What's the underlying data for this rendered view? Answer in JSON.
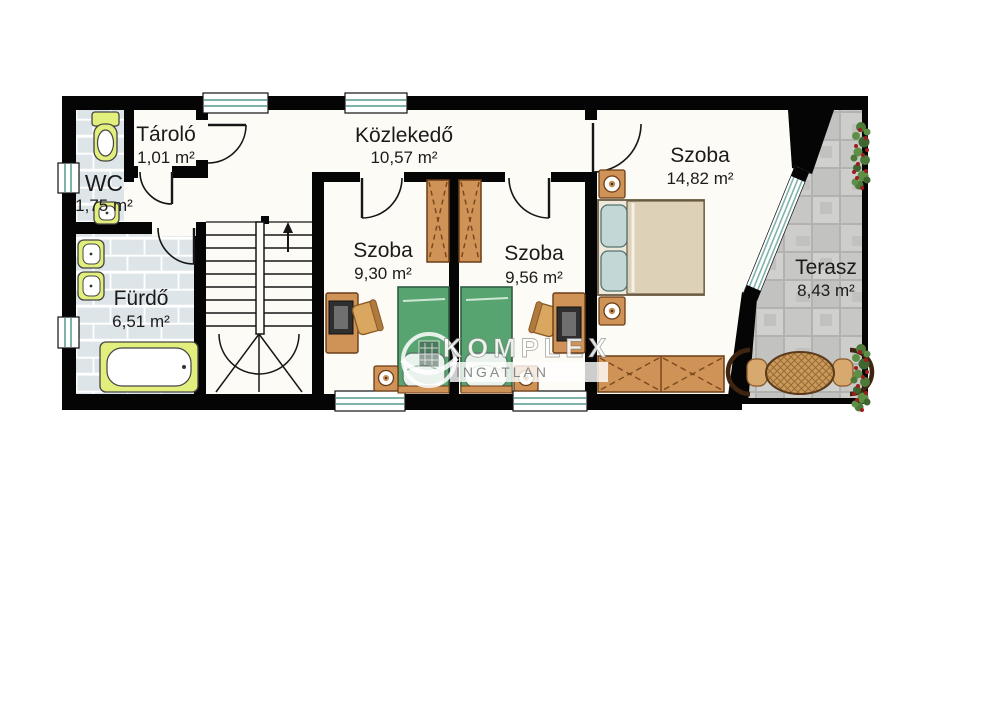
{
  "rooms": [
    {
      "id": "tarolo",
      "name": "Tároló",
      "area": "1,01 m²"
    },
    {
      "id": "wc",
      "name": "WC",
      "area": "1,75 m²"
    },
    {
      "id": "furdo",
      "name": "Fürdő",
      "area": "6,51 m²"
    },
    {
      "id": "kozlekedo",
      "name": "Közlekedő",
      "area": "10,57 m²"
    },
    {
      "id": "szoba-1",
      "name": "Szoba",
      "area": "9,30 m²"
    },
    {
      "id": "szoba-2",
      "name": "Szoba",
      "area": "9,56 m²"
    },
    {
      "id": "szoba-3",
      "name": "Szoba",
      "area": "14,82 m²"
    },
    {
      "id": "terasz",
      "name": "Terasz",
      "area": "8,43 m²"
    }
  ],
  "watermark": {
    "brand": "KOMPLEX",
    "sub": "INGATLAN"
  },
  "colors": {
    "wall": "#050505",
    "floor": "#fcfbf6",
    "bath_tile": "#dde5e9",
    "terrace_stone": "#c6c6c4",
    "window_glass": "#7fb3a9",
    "fixture_accent": "#e3ef7d",
    "bed_green": "#58a471",
    "wood": "#cf9257",
    "plant_green": "#4d7a39",
    "plant_berry": "#9e1d1d",
    "label_text": "#1b1b1b"
  }
}
